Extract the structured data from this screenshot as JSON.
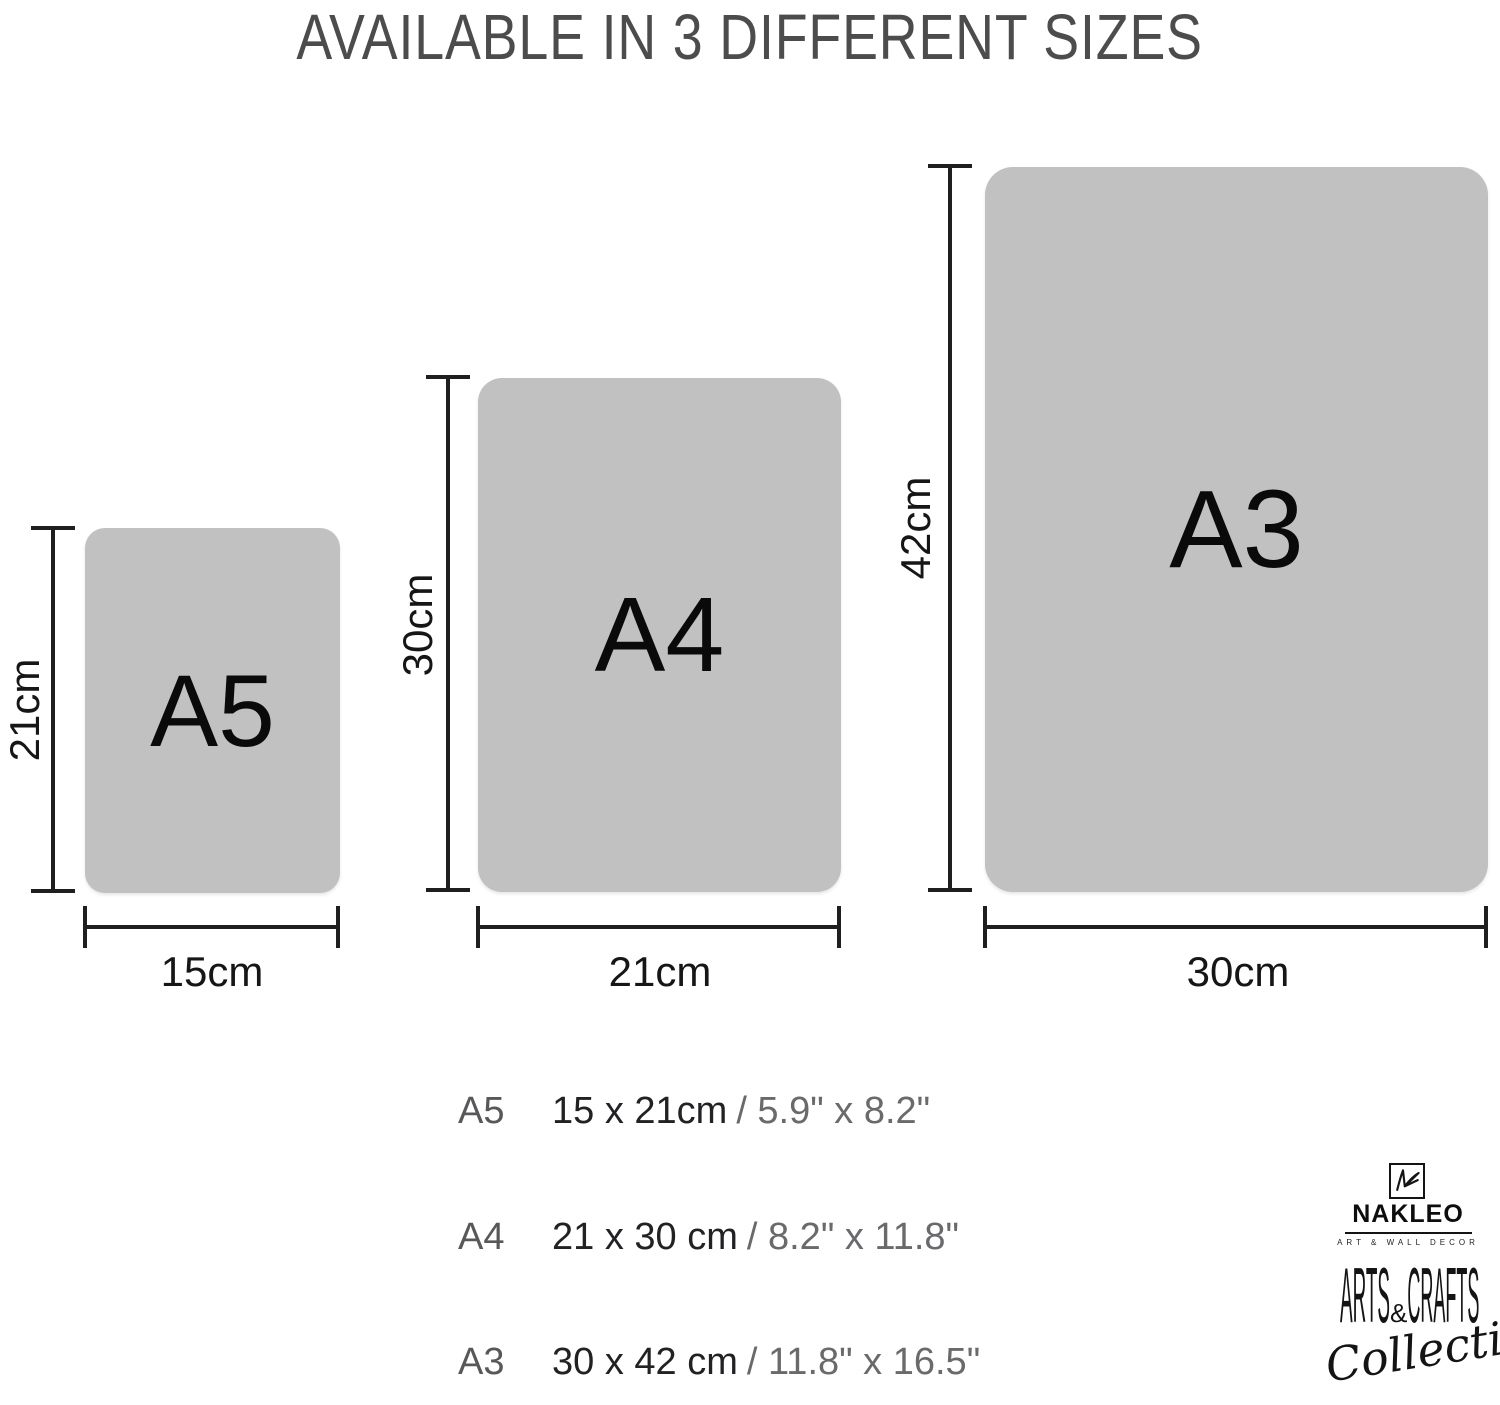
{
  "title": "AVAILABLE IN 3 DIFFERENT SIZES",
  "sizes": [
    {
      "label": "A5",
      "height_label": "21cm",
      "width_label": "15cm"
    },
    {
      "label": "A4",
      "height_label": "30cm",
      "width_label": "21cm"
    },
    {
      "label": "A3",
      "height_label": "42cm",
      "width_label": "30cm"
    }
  ],
  "size_list": [
    {
      "label": "A5",
      "metric": "15 x 21cm",
      "imperial": "/ 5.9\" x 8.2\""
    },
    {
      "label": "A4",
      "metric": "21 x 30 cm",
      "imperial": "/ 8.2\" x 11.8\""
    },
    {
      "label": "A3",
      "metric": "30 x 42 cm",
      "imperial": "/ 11.8\" x 16.5\""
    }
  ],
  "brand": {
    "name": "NAKLEO",
    "tagline": "ART & WALL DECOR",
    "collection": {
      "arts": "ARTS",
      "amp": "&",
      "crafts": "CRAFTS",
      "script": "Collection"
    }
  },
  "colors": {
    "panel_gray": "#c2c1c1",
    "line_ink": "#1f1f1f",
    "title_gray": "#4c4c4c",
    "list_label_gray": "#58585a",
    "imperial_gray": "#6a6a6c",
    "ink": "#0d0d0d"
  }
}
